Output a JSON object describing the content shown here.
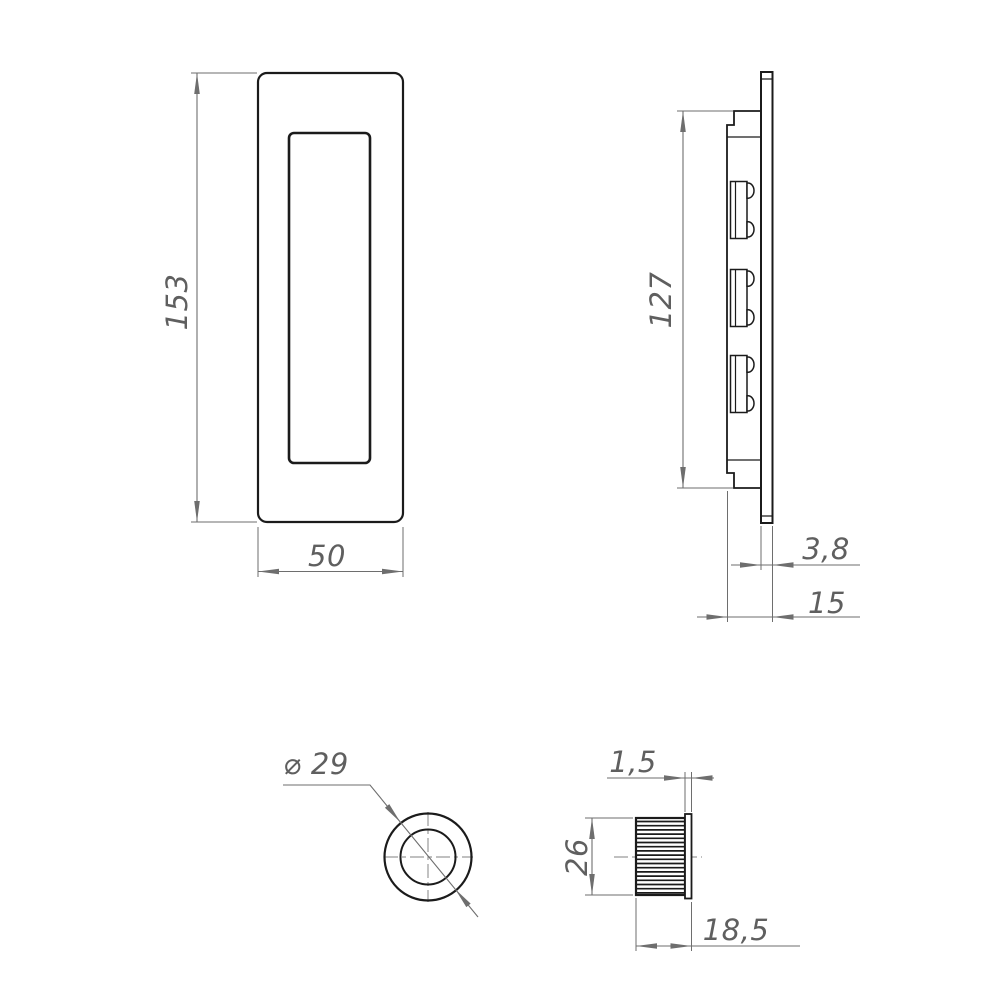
{
  "colors": {
    "object_line": "#1b1b1b",
    "dimension_line": "#6e6e6e",
    "dimension_text": "#5f5f5f",
    "centerline": "#9a9a9a",
    "background": "#ffffff"
  },
  "views": {
    "front": {
      "dim_height": "153",
      "dim_width": "50"
    },
    "side": {
      "dim_body_height": "127",
      "dim_plate_thickness": "3,8",
      "dim_total_depth": "15"
    },
    "circular": {
      "dim_diameter": "⌀ 29"
    },
    "bush": {
      "dim_collar_thickness": "1,5",
      "dim_diameter": "26",
      "dim_length": "18,5"
    }
  }
}
